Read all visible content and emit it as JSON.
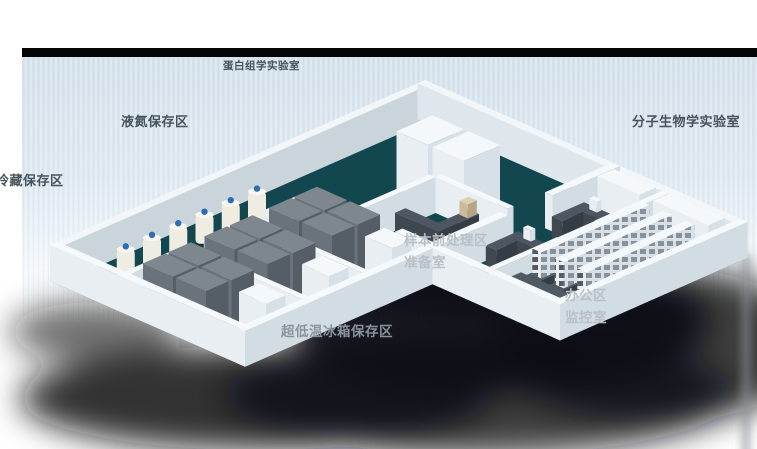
{
  "labels": {
    "proteomics_lab": "蛋白组学实验室",
    "liquid_nitrogen_area": "液氮保存区",
    "cold_storage_area": "冷藏保存区",
    "molecular_biology_lab": "分子生物学实验室",
    "sample_pretreatment_area": "样本前处理区",
    "preparation_room": "准备室",
    "office_area": "办公区",
    "monitoring_room": "监控室",
    "ult_freezer_area": "超低温冰箱保存区"
  },
  "colors": {
    "background": "#ffffff",
    "backdrop_panel": "#d8e3ed",
    "backdrop_top_bar": "#050505",
    "floor_teal": "#134750",
    "wall_top": "#f6f9fb",
    "wall_side": "#d2dce3",
    "wall_near": "#e9eef3",
    "freezer_top": "#7e878e",
    "freezer_front": "#6a737b",
    "freezer_side": "#555e66",
    "cabinet_white": "#f4f8fa",
    "dewar_body": "#efece1",
    "dewar_cap": "#2d6db5",
    "bench_dark": "#4d5661",
    "shadow": "#0d1013",
    "label_dark": "#46525c",
    "label_light": "#b9c0c6",
    "label_gray": "#8b939a"
  }
}
